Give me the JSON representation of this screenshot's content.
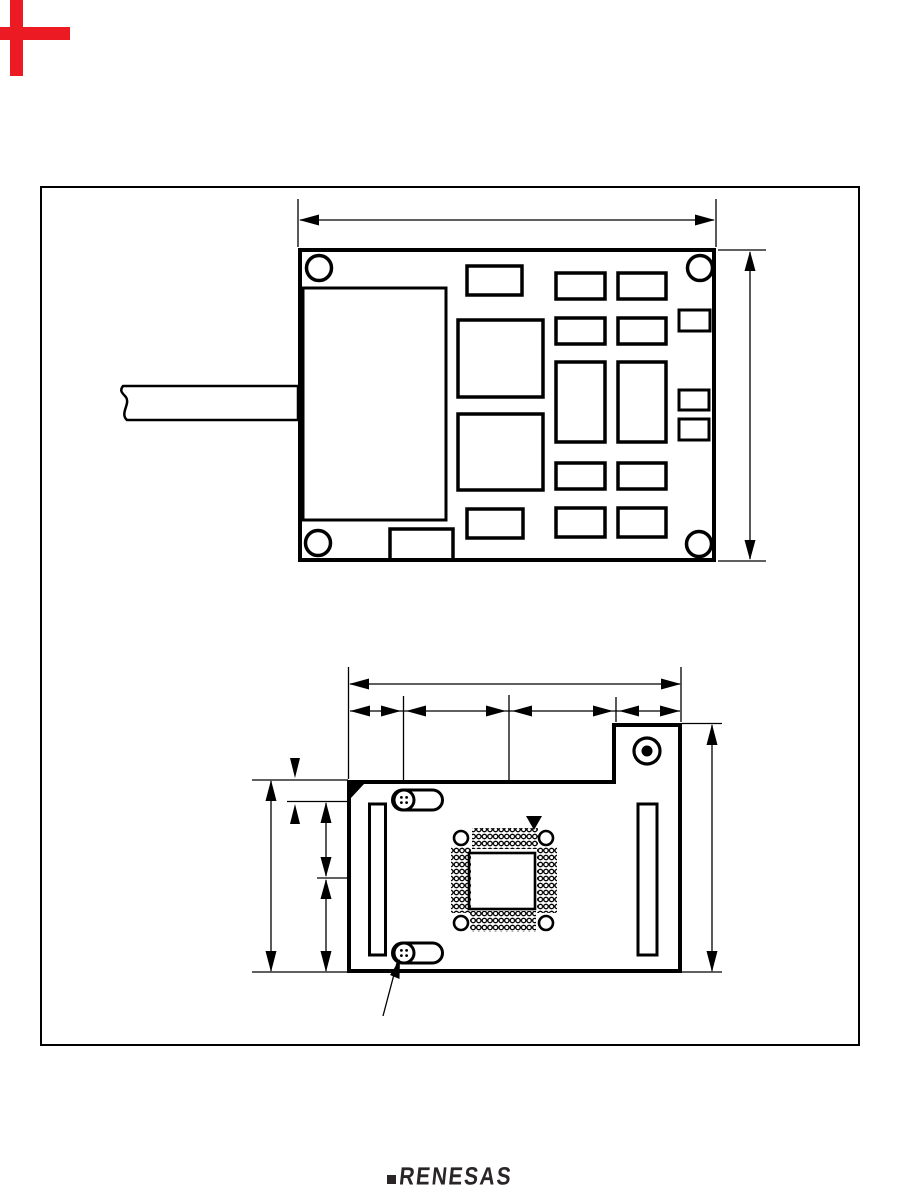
{
  "page": {
    "width": 907,
    "height": 1202,
    "background": "#ffffff"
  },
  "corner_marks": {
    "color": "#ec1b23"
  },
  "drawing": {
    "ink_color": "#000000",
    "views": [
      {
        "id": "pcb-top-view"
      },
      {
        "id": "pcb-bottom-view"
      }
    ]
  },
  "footer": {
    "logo_text": "RENESAS",
    "logo_color": "#2a2526"
  }
}
